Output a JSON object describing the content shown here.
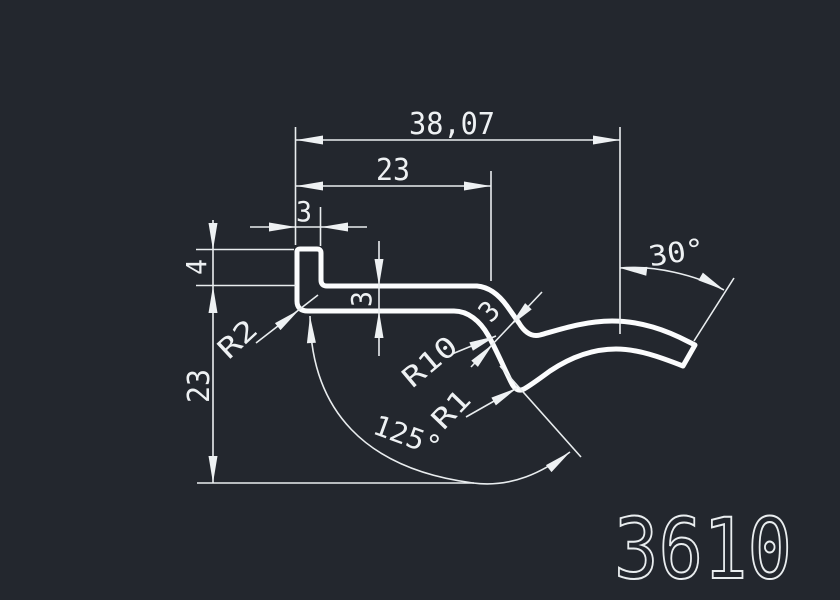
{
  "background_color": "#23272e",
  "line_color": "#eef1f3",
  "part_number": "3610",
  "dimensions": {
    "overall_width": "38,07",
    "upper_width": "23",
    "lip_width": "3",
    "lip_height": "4",
    "strip_thickness": "3",
    "profile_height": "23",
    "corner_radius": "R2",
    "bend_radius": "R10",
    "valley_radius": "R1",
    "slope_thickness": "3",
    "end_angle": "30°",
    "bend_angle": "125°"
  }
}
